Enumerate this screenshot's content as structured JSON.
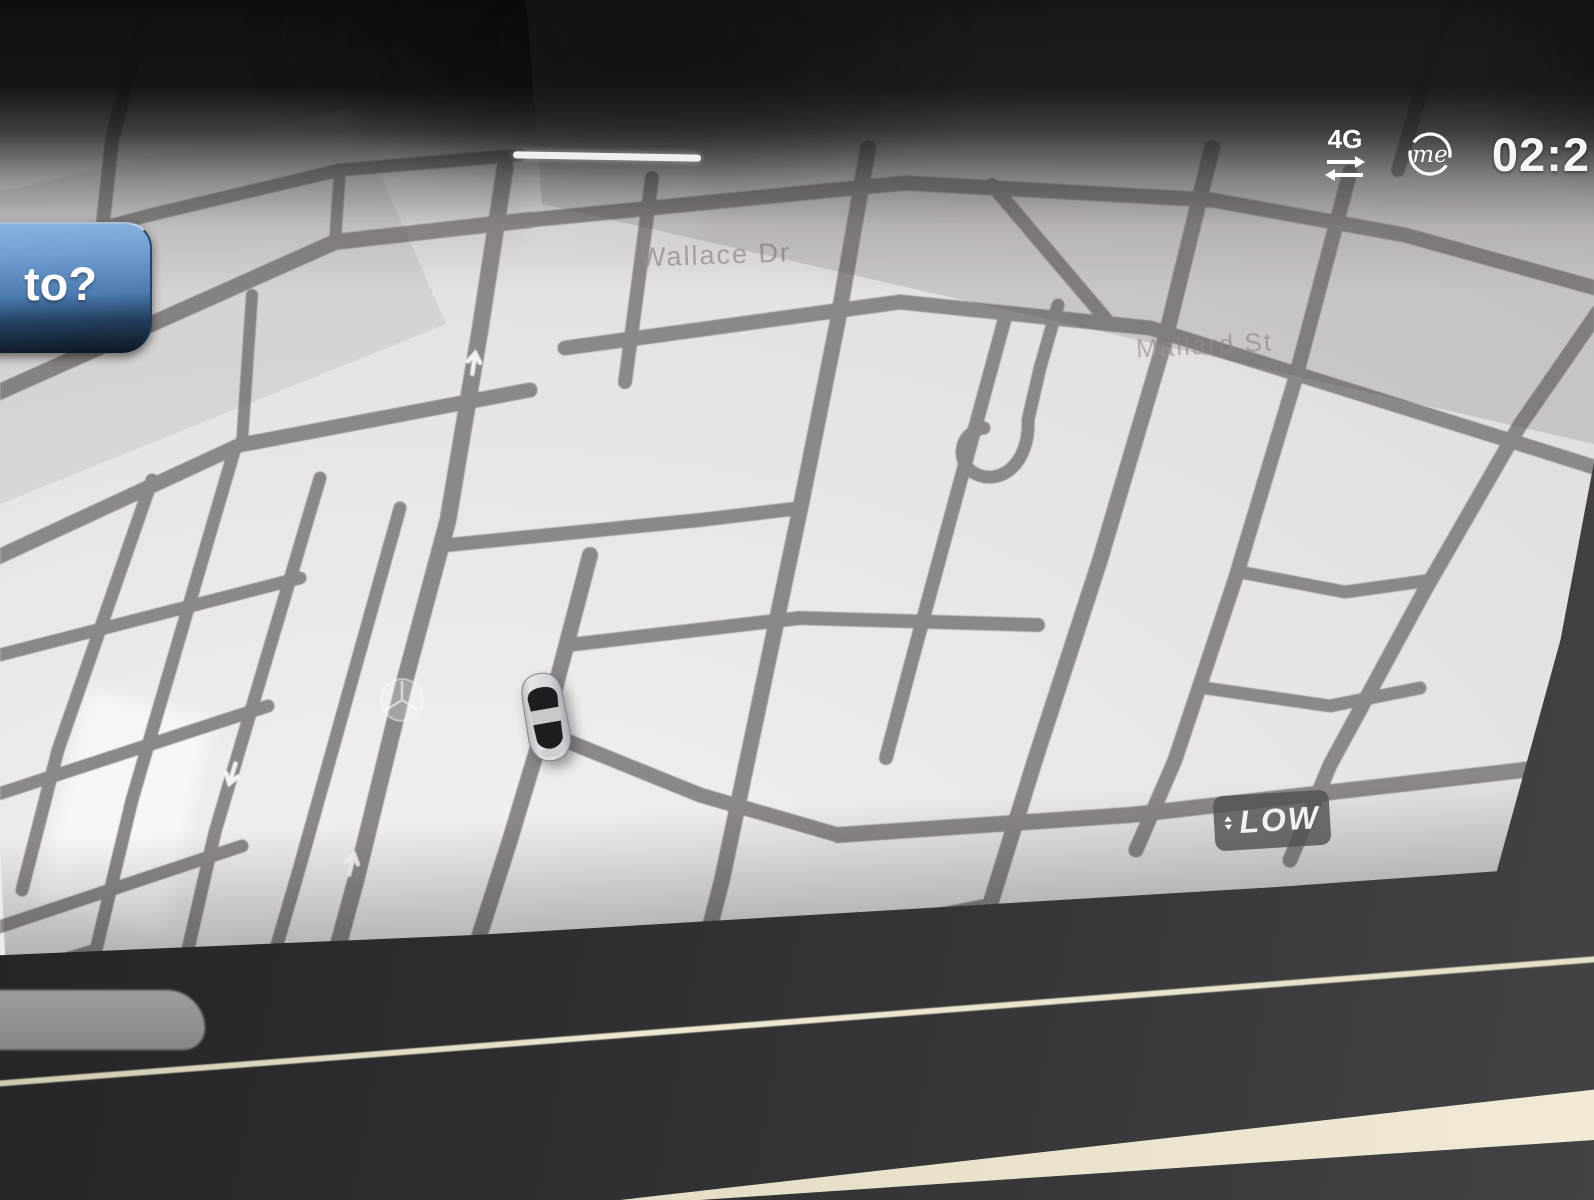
{
  "status_bar": {
    "network_label": "4G",
    "me_label": "me",
    "clock": "02:2"
  },
  "nav_button": {
    "label": "to?"
  },
  "map": {
    "street_labels": {
      "wallace": "Wallace Dr",
      "mallard": "Mallard St"
    },
    "scale_badge": {
      "label": "LOW"
    },
    "vehicle_marker": "silver-car-3d",
    "watermark": "mercedes-star",
    "colors": {
      "road": "#8d8888",
      "map_background": "#eae6e6",
      "button_blue": "#4a7ab0",
      "badge_gray": "#545254",
      "trim_cream": "#e8e2cc"
    }
  }
}
